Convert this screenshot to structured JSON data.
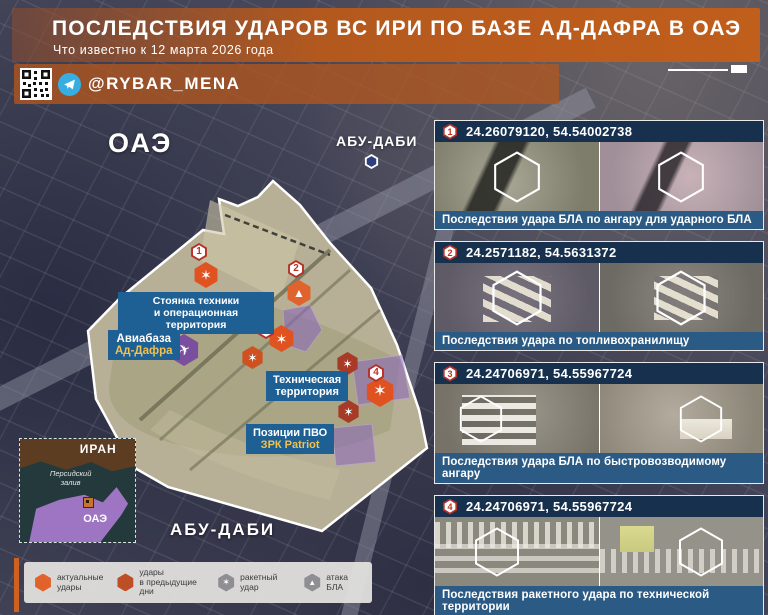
{
  "header": {
    "title": "ПОСЛЕДСТВИЯ УДАРОВ ВС ИРИ ПО БАЗЕ АД-ДАФРА В ОАЭ",
    "subtitle": "Что известно к 12 марта 2026 года",
    "handle": "@RYBAR_MENA"
  },
  "map": {
    "country": "ОАЭ",
    "city_top": "АБУ-ДАБИ",
    "city_bottom": "АБУ-ДАБИ",
    "label_parking": "Стоянка техники\nи операционная территория",
    "label_airbase_1": "Авиабаза",
    "label_airbase_2": "Ад-Дафра",
    "label_tech": "Техническая\nтерритория",
    "label_pvo_1": "Позиции ПВО",
    "label_pvo_2": "ЗРК Patriot",
    "marker_1": "1",
    "marker_2": "2",
    "marker_3": "3",
    "marker_4": "4"
  },
  "inset": {
    "iran": "ИРАН",
    "gulf": "Персидский\nзалив",
    "uae": "ОАЭ"
  },
  "cards": [
    {
      "num": "1",
      "coords": "24.26079120, 54.54002738",
      "caption": "Последствия удара БЛА по ангару для ударного БЛА"
    },
    {
      "num": "2",
      "coords": "24.2571182, 54.5631372",
      "caption": "Последствия удара по топливохранилищу"
    },
    {
      "num": "3",
      "coords": "24.24706971, 54.55967724",
      "caption": "Последствия удара БЛА по быстровозводимому ангару"
    },
    {
      "num": "4",
      "coords": "24.24706971, 54.55967724",
      "caption": "Последствия ракетного удара по технической территории"
    }
  ],
  "legend": {
    "items": [
      {
        "label": "актуальные\nудары"
      },
      {
        "label": "удары\nв предыдущие дни"
      },
      {
        "label": "ракетный удар"
      },
      {
        "label": "атака БЛА"
      }
    ]
  },
  "icons": {
    "explosion_glyph": "✶",
    "drone_glyph": "▲",
    "plane_glyph": "✈"
  },
  "colors": {
    "accent_orange": "#c05e1c",
    "card_header_blue": "#16304e",
    "caption_blue": "#2b5b85",
    "label_blue": "#1e6094",
    "strike_bright": "#e05220",
    "strike_dark": "#a83a28",
    "highlight_purple": "#8d6bb8",
    "yellow_text": "#f2c14e"
  }
}
